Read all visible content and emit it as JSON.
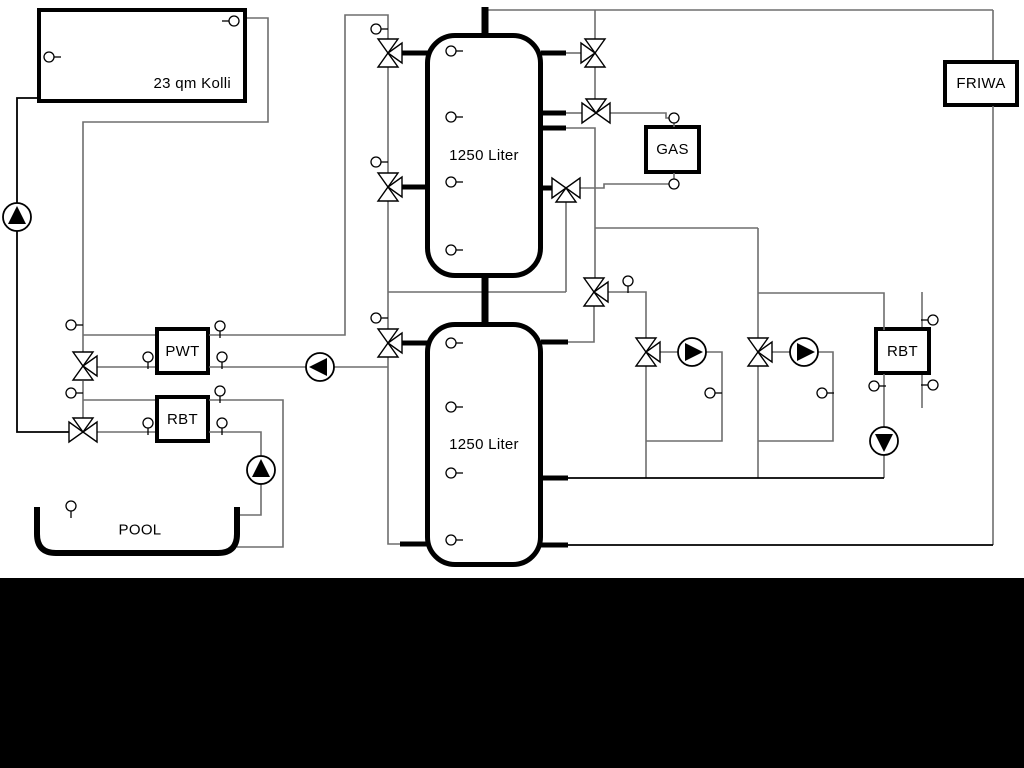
{
  "labels": {
    "collector": "23 qm Kolli",
    "tank_top": "1250 Liter",
    "tank_bottom": "1250 Liter",
    "gas_boiler": "GAS",
    "friwa": "FRIWA",
    "pwt": "PWT",
    "rbt_left": "RBT",
    "rbt_right": "RBT",
    "pool": "POOL"
  },
  "colors": {
    "pipe_gray": "#6e6e6e",
    "pipe_black": "#000000",
    "component_stroke": "#000000",
    "component_fill": "#ffffff",
    "background": "#ffffff",
    "footer_band": "#000000"
  },
  "icons": {
    "pump": "pump-icon",
    "three_way_valve": "three-way-valve-icon",
    "temperature_sensor": "temp-sensor-icon"
  }
}
